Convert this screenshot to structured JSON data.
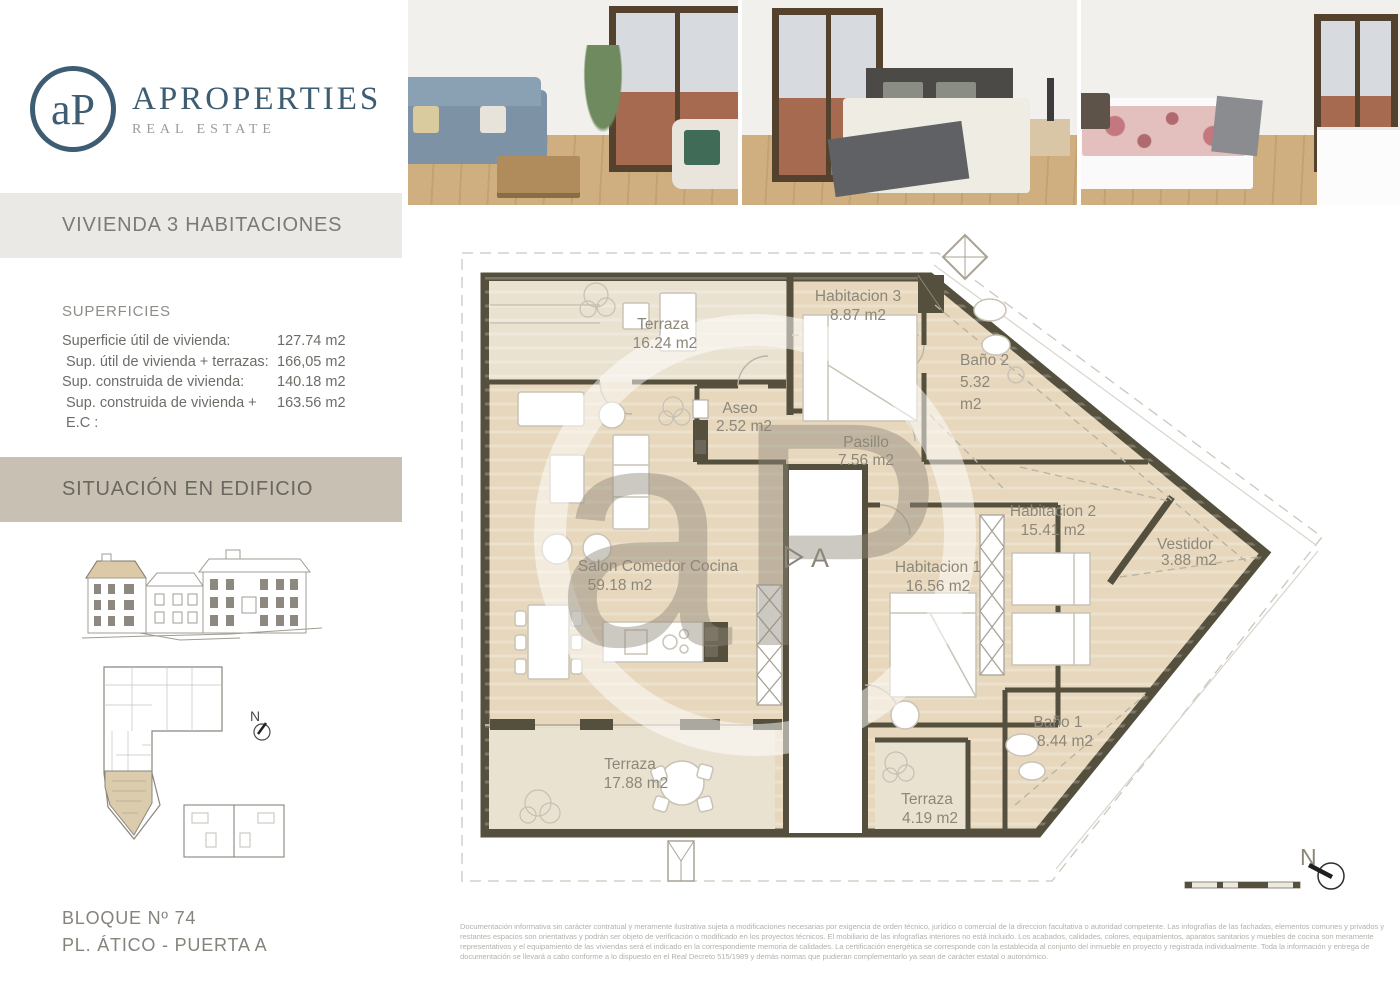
{
  "brand": {
    "monogram": "aP",
    "name": "APROPERTIES",
    "tagline": "REAL ESTATE",
    "brand_color": "#3e5c72"
  },
  "sidebar": {
    "section1_title": "VIVIENDA 3 HABITACIONES",
    "superficies": {
      "title": "SUPERFICIES",
      "rows": [
        {
          "label": "Superficie útil de vivienda:",
          "value": "127.74 m2"
        },
        {
          "label": "Sup. útil de vivienda + terrazas:",
          "value": "166,05 m2"
        },
        {
          "label": "Sup. construida de vivienda:",
          "value": "140.18 m2"
        },
        {
          "label": "Sup. construida de vivienda + E.C :",
          "value": "163.56 m2"
        }
      ]
    },
    "section2_title": "SITUACIÓN EN EDIFICIO",
    "block_line1": "BLOQUE Nº 74",
    "block_line2": "PL. ÁTICO - PUERTA A"
  },
  "photos": [
    {
      "alt": "living-room"
    },
    {
      "alt": "bedroom-double"
    },
    {
      "alt": "bedroom-single"
    }
  ],
  "floor_plan": {
    "rooms": {
      "terraza_top": {
        "name": "Terraza",
        "area": "16.24 m2"
      },
      "habitacion3": {
        "name": "Habitacion 3",
        "area": "8.87 m2"
      },
      "bano2": {
        "name": "Baño  2",
        "area_value": "5.32",
        "area_unit": "m2"
      },
      "aseo": {
        "name": "Aseo",
        "area": "2.52 m2"
      },
      "pasillo": {
        "name": "Pasillo",
        "area": "7.56 m2"
      },
      "salon": {
        "name": "Salon Comedor Cocina",
        "area": "59.18 m2"
      },
      "habitacion1": {
        "name": "Habitacion 1",
        "area": "16.56 m2"
      },
      "habitacion2": {
        "name": "Habitacion 2",
        "area": "15.41 m2"
      },
      "vestidor": {
        "name": "Vestidor",
        "area": "3.88 m2"
      },
      "bano1": {
        "name": "Baño 1",
        "area": "8.44 m2"
      },
      "terraza_main": {
        "name": "Terraza",
        "area": "17.88 m2"
      },
      "terraza_small": {
        "name": "Terraza",
        "area": "4.19 m2"
      }
    },
    "section_marker": "A",
    "compass_label": "N",
    "colors": {
      "wall": "#55503e",
      "floor": "#e7d8bd",
      "terrace": "#eae2d1",
      "label": "#8d8779"
    }
  },
  "footer": {
    "disclaimer_lines": [
      "Documentación informativa sin carácter contratual y meramente ilustrativa sujeta a modificaciones necesarias por exigencia de orden técnico, jurídico o comercial de la direccion facultativa o autoridad competente. Las infografías de las fachadas, elementos comunes y privados y",
      "restantes espacios son orientativas y podrán ser objeto de verificación o modificado en los proyectos técnicos. El mobiliario de las infografías interiores no está incluido. Los acabados, calidades, colores, equipamientos, aparatos sanitarios y muebles de cocina son meramente",
      "representativos y el equipamiento de las viviendas será el indicado en la correspondiente memoria de calidades. La certificación energética se corresponde con la establecida al conjunto del inmueble en proyecto y registrada individualmente. Toda la información y entrega de",
      "documentación se llevará a cabo conforme a lo dispuesto en el Real Decreto 515/1989 y demás normas que pudieran complementarlo ya sean de carácter estatal o autonómico."
    ]
  }
}
